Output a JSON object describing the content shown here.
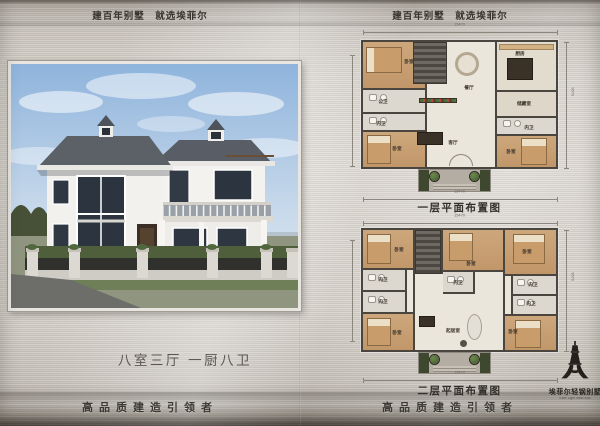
{
  "pages": {
    "left": {
      "header": "建百年别墅　就选埃菲尔",
      "feature_text": "八室三厅 一厨八卫",
      "footer": "高品质建造引领者"
    },
    "right": {
      "header": "建百年别墅　就选埃菲尔",
      "footer": "高品质建造引领者"
    }
  },
  "plans": {
    "first": {
      "caption": "一层平面布置图",
      "dim_top": "15470",
      "dim_bottom": "15470",
      "dim_side": "9570"
    },
    "second": {
      "caption": "二层平面布置图",
      "dim_top": "15470",
      "dim_bottom": "15470",
      "dim_side": "9570"
    }
  },
  "room_labels": {
    "bedroom": "卧室",
    "public_bath": "公卫",
    "ensuite": "内卫",
    "dining": "餐厅",
    "living": "客厅",
    "kitchen": "厨房",
    "storage": "储藏室",
    "sitting": "起居室"
  },
  "logo": {
    "title": "埃菲尔轻钢别墅",
    "subtitle": "Eiffel Light Steel Villa"
  },
  "colors": {
    "metal_light": "#dedad4",
    "metal_dark": "#79736b",
    "roof": "#5c6168",
    "wall_line": "#4a453e",
    "wood_floor": "#c9a478",
    "sky": "#8fb4dc"
  }
}
